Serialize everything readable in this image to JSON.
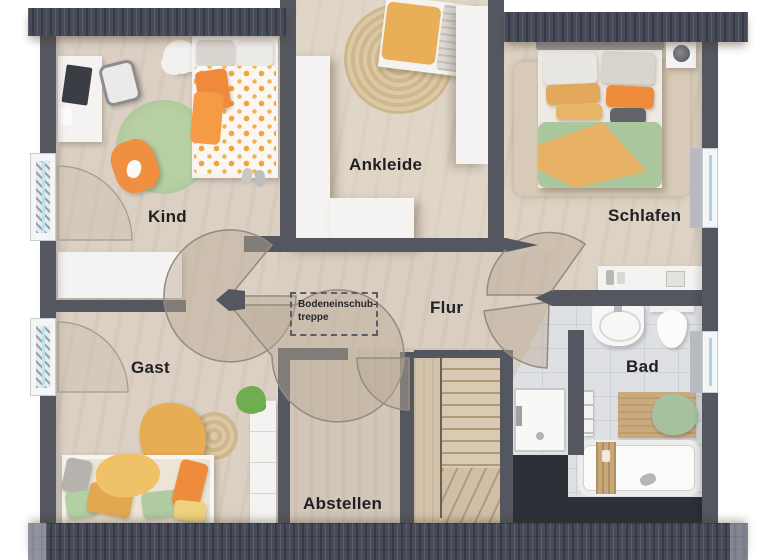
{
  "title": "Dachgeschoss Grundriss",
  "labels": {
    "kind": "Kind",
    "ankleide": "Ankleide",
    "schlafen": "Schlafen",
    "flur": "Flur",
    "gast": "Gast",
    "abstellen": "Abstellen",
    "bad": "Bad",
    "attic1": "Bodeneinschub-",
    "attic2": "treppe"
  },
  "rooms": [
    {
      "name": "Kind",
      "furniture": [
        "desk",
        "office-chair",
        "single-bed",
        "round-rug",
        "beanbag",
        "sideboard",
        "flower-rug"
      ]
    },
    {
      "name": "Ankleide",
      "furniture": [
        "wardrobe-left",
        "wardrobe-corner",
        "wardrobe-right",
        "bench",
        "jute-rug"
      ]
    },
    {
      "name": "Schlafen",
      "furniture": [
        "double-bed",
        "nightstand",
        "lamp",
        "rug",
        "dresser"
      ]
    },
    {
      "name": "Flur",
      "furniture": [
        "attic-ladder-outline"
      ]
    },
    {
      "name": "Gast",
      "furniture": [
        "daybed",
        "blanket",
        "jute-rug",
        "shelf",
        "plant"
      ]
    },
    {
      "name": "Abstellen",
      "furniture": []
    },
    {
      "name": "Bad",
      "furniture": [
        "sink",
        "toilet",
        "shower",
        "bathtub",
        "bath-mat",
        "towel",
        "towel-rail"
      ]
    }
  ],
  "colors": {
    "wall": "#54575f",
    "roof": "#474b59",
    "wood_floor": "#dbd0c3",
    "tile_floor": "#dee0e4",
    "accent_orange": "#ef8c3c",
    "accent_mustard": "#e6ad55",
    "accent_green": "#abc79d",
    "jute": "#d5c098",
    "window_glass": "#a8d4e6"
  }
}
